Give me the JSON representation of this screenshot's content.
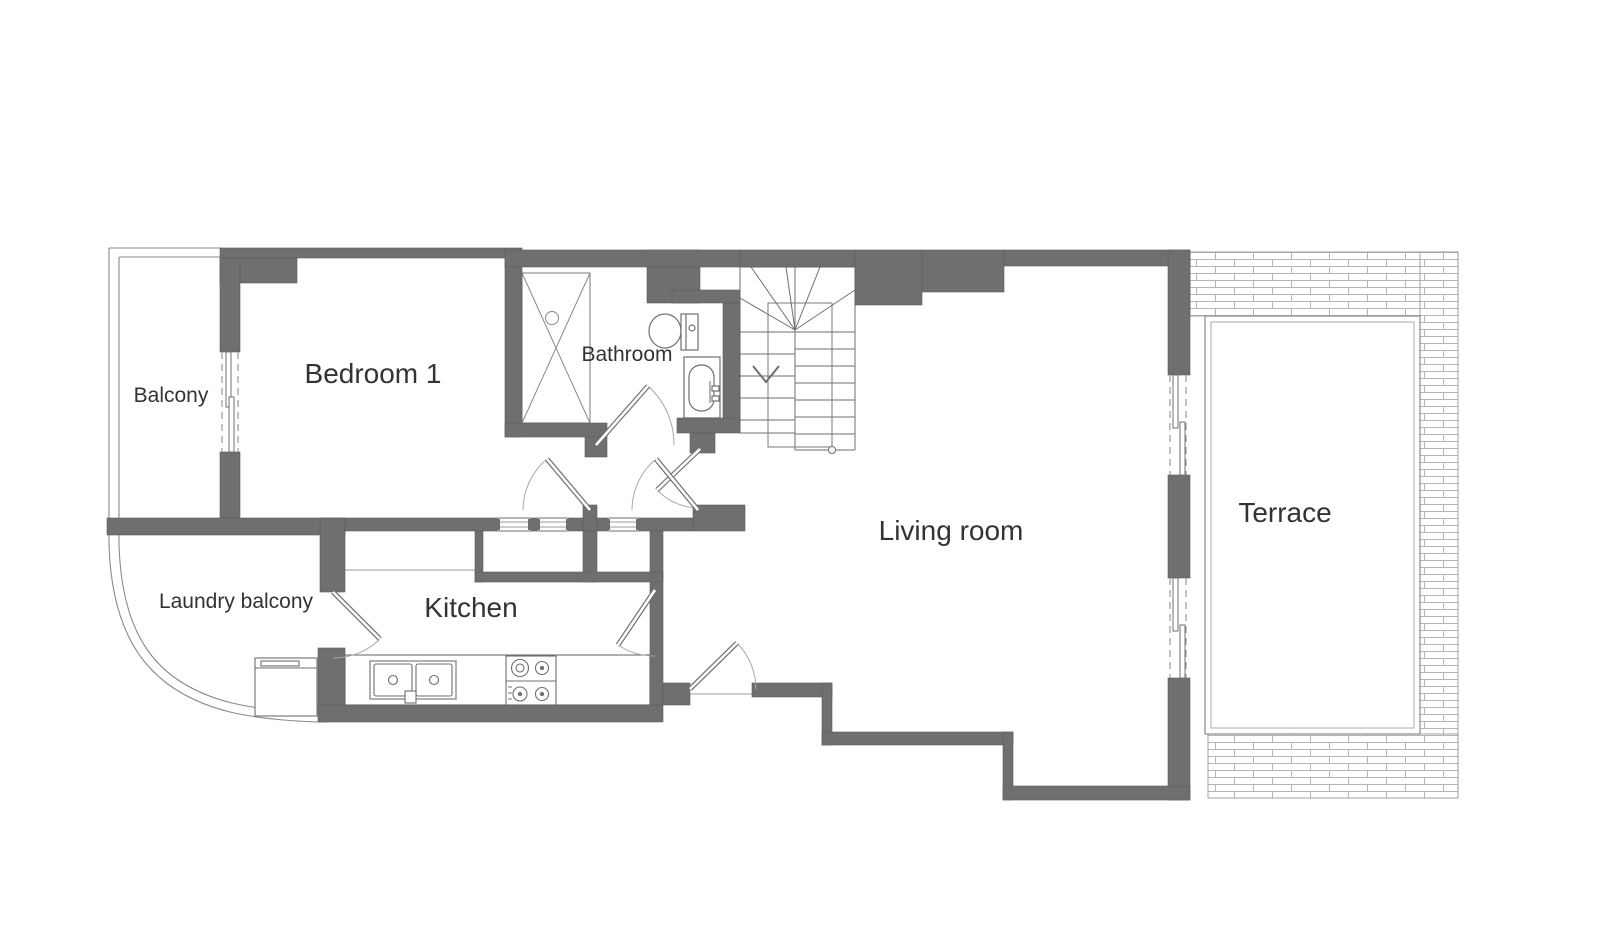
{
  "plan": {
    "type": "architectural-floor-plan",
    "colors": {
      "wall": "#6f6f6f",
      "wall_edge": "#5d5d5d",
      "thin_line": "#8a8a8a",
      "fixture_line": "#6f6f6f",
      "hatch_line": "#b5b5b5",
      "hatch_border": "#8f8f8f",
      "arc_line": "#a0a0a0",
      "text": "#333333",
      "background": "#ffffff"
    },
    "rooms": [
      {
        "id": "balcony",
        "label": "Balcony"
      },
      {
        "id": "bedroom-1",
        "label": "Bedroom 1"
      },
      {
        "id": "bathroom",
        "label": "Bathroom"
      },
      {
        "id": "living-room",
        "label": "Living room"
      },
      {
        "id": "terrace",
        "label": "Terrace"
      },
      {
        "id": "laundry-balcony",
        "label": "Laundry balcony"
      },
      {
        "id": "kitchen",
        "label": "Kitchen"
      }
    ],
    "fixtures": [
      "staircase-with-down-arrow",
      "shower",
      "toilet",
      "washbasin",
      "kitchen-counter",
      "double-kitchen-sink",
      "four-burner-stove",
      "washing-machine",
      "sliding-door-balcony",
      "sliding-door-terrace-upper",
      "sliding-door-terrace-lower",
      "hinged-doors",
      "internal-window-vents",
      "tiled-terrace-surround"
    ]
  }
}
